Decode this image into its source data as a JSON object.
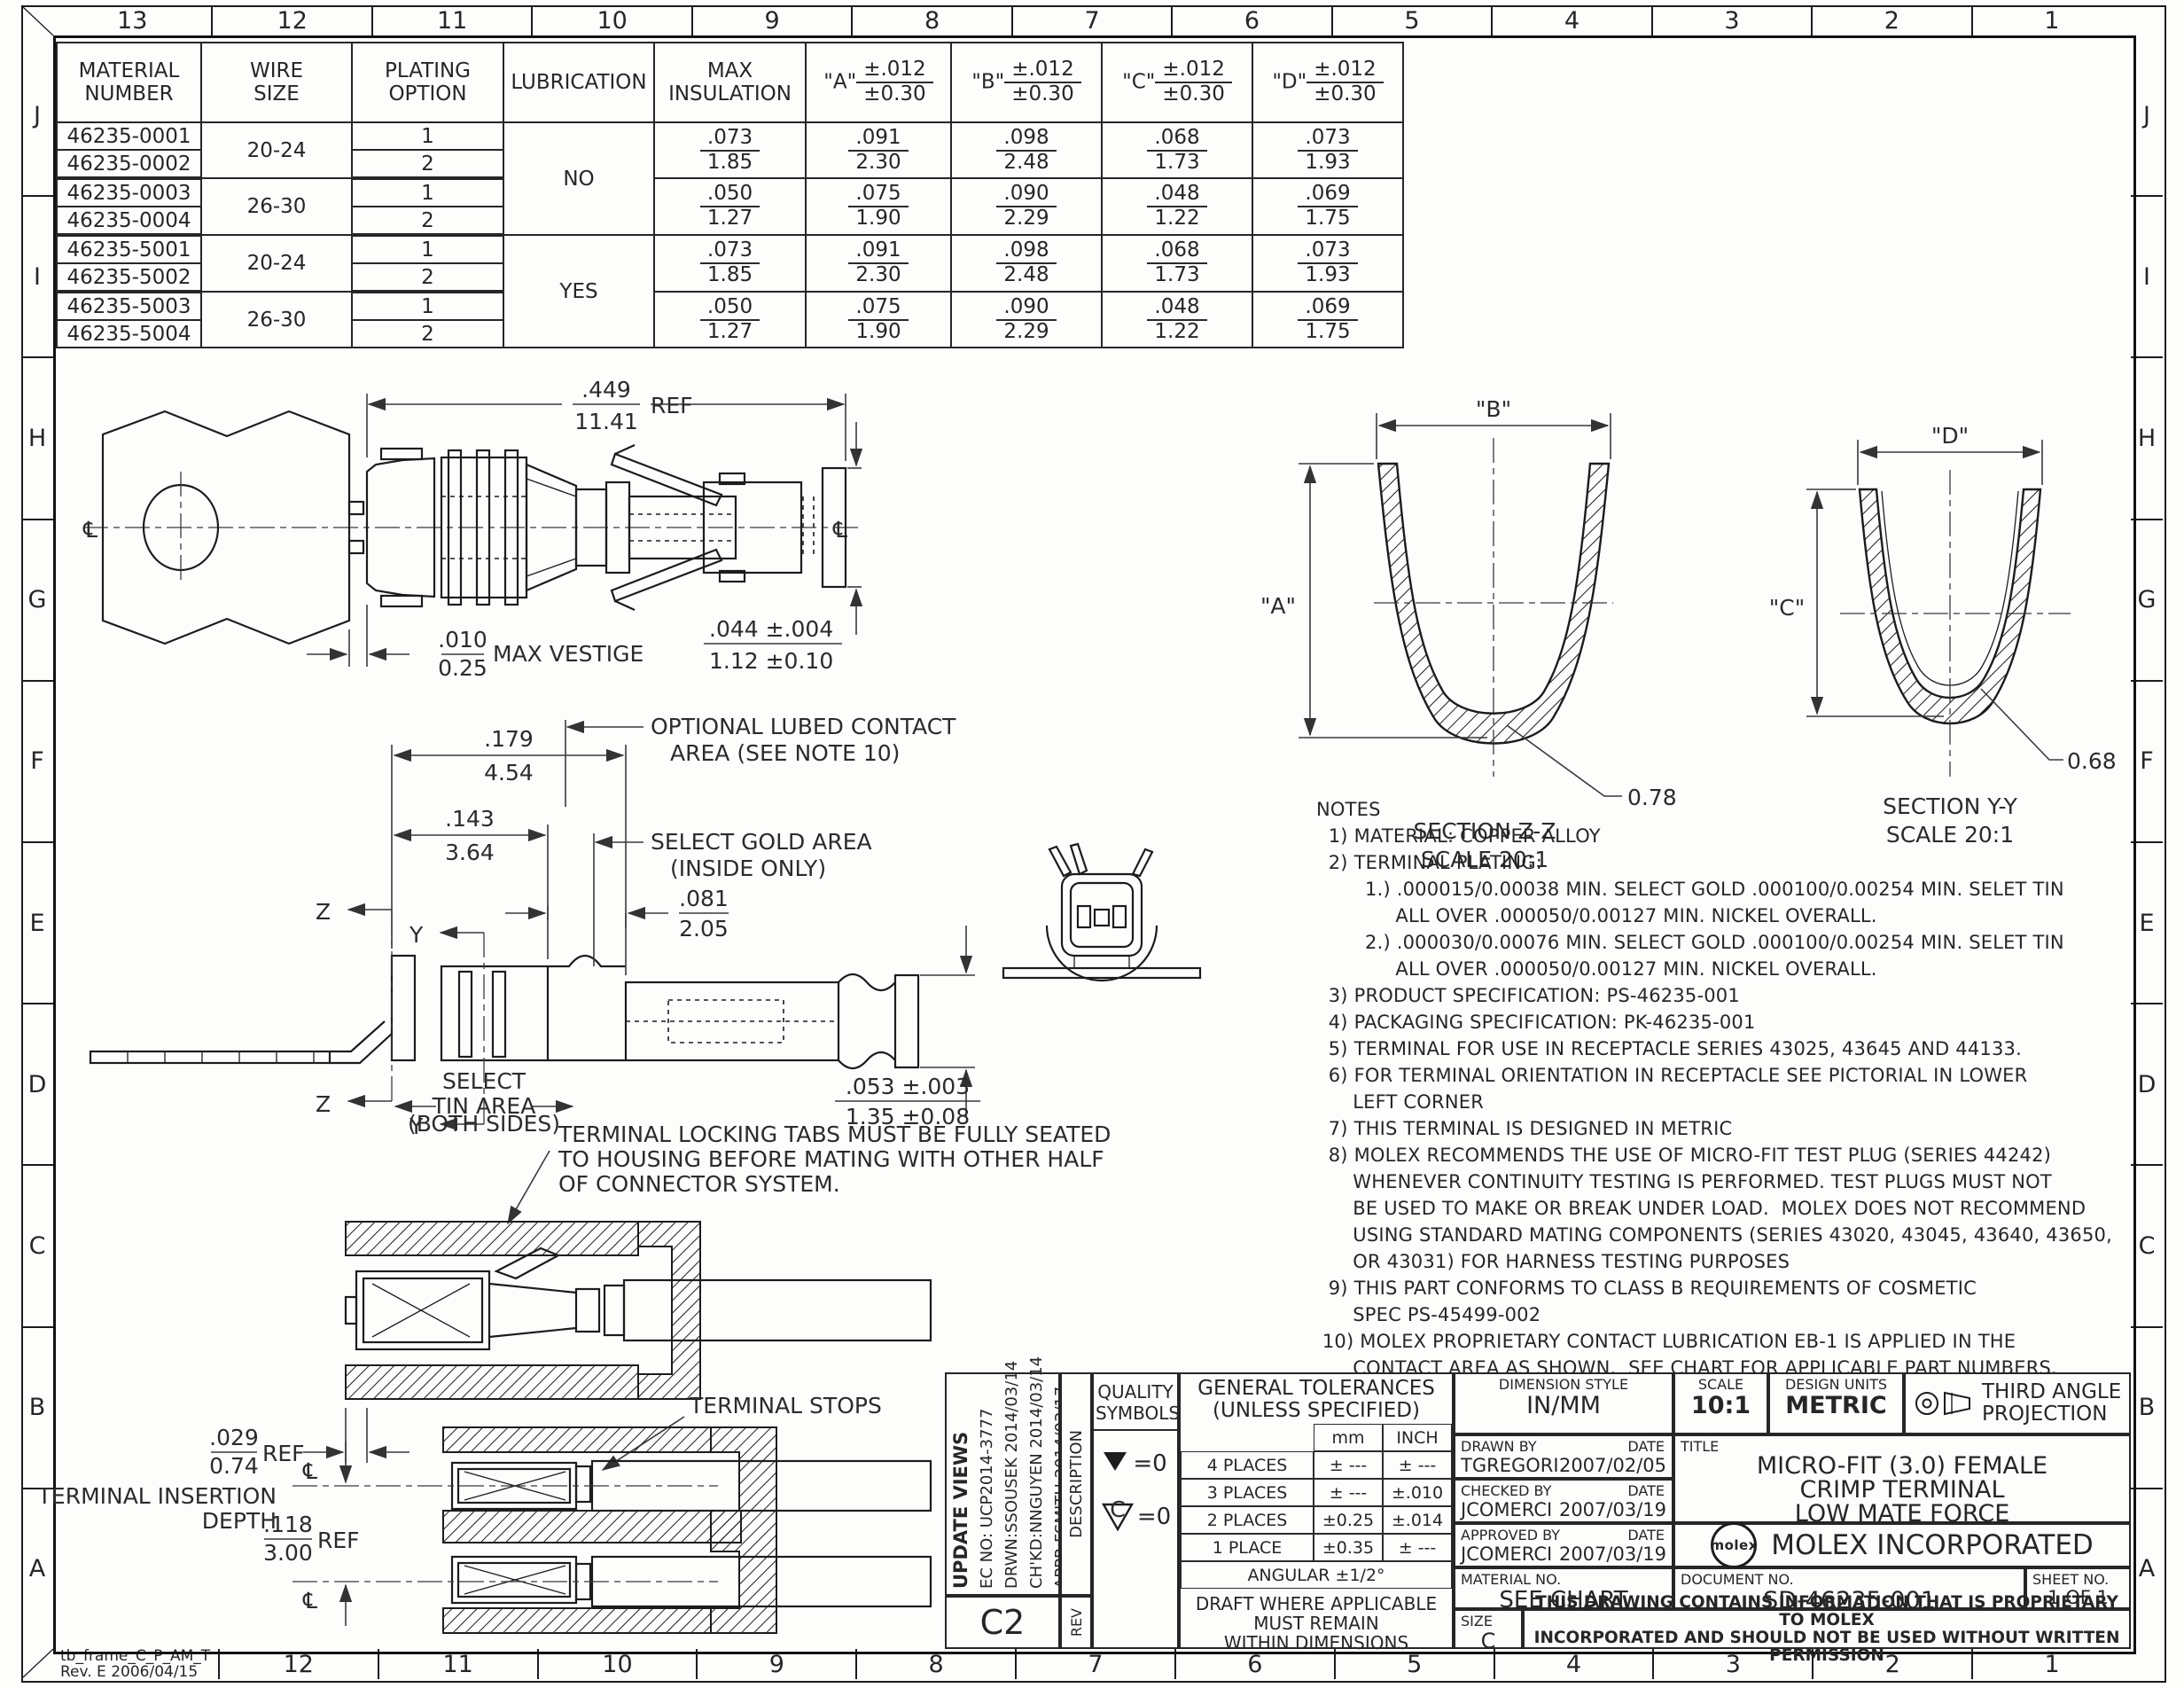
{
  "sheet": {
    "zones_top": [
      "13",
      "12",
      "11",
      "10",
      "9",
      "8",
      "7",
      "6",
      "5",
      "4",
      "3",
      "2",
      "1"
    ],
    "zones_bottom": [
      "12",
      "11",
      "10",
      "9",
      "8",
      "7",
      "6",
      "5",
      "4",
      "3",
      "2",
      "1"
    ],
    "zones_left": [
      "J",
      "I",
      "H",
      "G",
      "F",
      "E",
      "D",
      "C",
      "B",
      "A"
    ],
    "zones_right": [
      "J",
      "I",
      "H",
      "G",
      "F",
      "E",
      "D",
      "C",
      "B",
      "A"
    ],
    "frame_stamp": "tb_frame_C_P_AM_T\nRev. E 2006/04/15"
  },
  "parts_table": {
    "col_material": "MATERIAL\nNUMBER",
    "col_wire": "WIRE\nSIZE",
    "col_plating": "PLATING\nOPTION",
    "col_lube": "LUBRICATION",
    "col_ins": "MAX\nINSULATION",
    "dim_names": [
      "\"A\"",
      "\"B\"",
      "\"C\"",
      "\"D\""
    ],
    "tol_in": "±.012",
    "tol_mm": "±0.30",
    "lube_no": "NO",
    "lube_yes": "YES",
    "groups": [
      {
        "wire": "20-24",
        "rows": [
          [
            "46235-0001",
            "1"
          ],
          [
            "46235-0002",
            "2"
          ]
        ],
        "ins": [
          ".073",
          "1.85"
        ],
        "a": [
          ".091",
          "2.30"
        ],
        "b": [
          ".098",
          "2.48"
        ],
        "c": [
          ".068",
          "1.73"
        ],
        "d": [
          ".073",
          "1.93"
        ]
      },
      {
        "wire": "26-30",
        "rows": [
          [
            "46235-0003",
            "1"
          ],
          [
            "46235-0004",
            "2"
          ]
        ],
        "ins": [
          ".050",
          "1.27"
        ],
        "a": [
          ".075",
          "1.90"
        ],
        "b": [
          ".090",
          "2.29"
        ],
        "c": [
          ".048",
          "1.22"
        ],
        "d": [
          ".069",
          "1.75"
        ]
      },
      {
        "wire": "20-24",
        "rows": [
          [
            "46235-5001",
            "1"
          ],
          [
            "46235-5002",
            "2"
          ]
        ],
        "ins": [
          ".073",
          "1.85"
        ],
        "a": [
          ".091",
          "2.30"
        ],
        "b": [
          ".098",
          "2.48"
        ],
        "c": [
          ".068",
          "1.73"
        ],
        "d": [
          ".073",
          "1.93"
        ]
      },
      {
        "wire": "26-30",
        "rows": [
          [
            "46235-5003",
            "1"
          ],
          [
            "46235-5004",
            "2"
          ]
        ],
        "ins": [
          ".050",
          "1.27"
        ],
        "a": [
          ".075",
          "1.90"
        ],
        "b": [
          ".090",
          "2.29"
        ],
        "c": [
          ".048",
          "1.22"
        ],
        "d": [
          ".069",
          "1.75"
        ]
      }
    ]
  },
  "view_crimped": {
    "cl": "℄",
    "ref_in": ".449",
    "ref_mm": "11.41",
    "ref_label": "REF",
    "vest_in": ".010",
    "vest_mm": "0.25",
    "vest_label": "MAX VESTIGE",
    "tip_in": ".044 ±.004",
    "tip_mm": "1.12 ±0.10"
  },
  "section_zz": {
    "b": "\"B\"",
    "a": "\"A\"",
    "r": "0.78",
    "title": "SECTION Z-Z",
    "scale": "SCALE 20:1"
  },
  "section_yy": {
    "d": "\"D\"",
    "c": "\"C\"",
    "r": "0.68",
    "title": "SECTION Y-Y",
    "scale": "SCALE 20:1"
  },
  "view_side": {
    "z": "Z",
    "y": "Y",
    "d1_in": ".179",
    "d1_mm": "4.54",
    "d2_in": ".143",
    "d2_mm": "3.64",
    "d3_in": ".081",
    "d3_mm": "2.05",
    "d4_in": ".053 ±.003",
    "d4_mm": "1.35 ±0.08",
    "lube1": "OPTIONAL LUBED CONTACT",
    "lube2": "AREA (SEE NOTE 10)",
    "gold1": "SELECT GOLD AREA",
    "gold2": "(INSIDE ONLY)",
    "tin1": "SELECT",
    "tin2": "TIN AREA",
    "tin3": "(BOTH SIDES)"
  },
  "notes": {
    "text": "NOTES\n  1) MATERIAL: COPPER ALLOY\n  2) TERMINAL PLATING:\n        1.) .000015/0.00038 MIN. SELECT GOLD .000100/0.00254 MIN. SELET TIN\n             ALL OVER .000050/0.00127 MIN. NICKEL OVERALL.\n        2.) .000030/0.00076 MIN. SELECT GOLD .000100/0.00254 MIN. SELET TIN\n             ALL OVER .000050/0.00127 MIN. NICKEL OVERALL.\n  3) PRODUCT SPECIFICATION: PS-46235-001\n  4) PACKAGING SPECIFICATION: PK-46235-001\n  5) TERMINAL FOR USE IN RECEPTACLE SERIES 43025, 43645 AND 44133.\n  6) FOR TERMINAL ORIENTATION IN RECEPTACLE SEE PICTORIAL IN LOWER\n      LEFT CORNER\n  7) THIS TERMINAL IS DESIGNED IN METRIC\n  8) MOLEX RECOMMENDS THE USE OF MICRO-FIT TEST PLUG (SERIES 44242)\n      WHENEVER CONTINUITY TESTING IS PERFORMED. TEST PLUGS MUST NOT\n      BE USED TO MAKE OR BREAK UNDER LOAD.  MOLEX DOES NOT RECOMMEND\n      USING STANDARD MATING COMPONENTS (SERIES 43020, 43045, 43640, 43650,\n      OR 43031) FOR HARNESS TESTING PURPOSES\n  9) THIS PART CONFORMS TO CLASS B REQUIREMENTS OF COSMETIC\n      SPEC PS-45499-002\n 10) MOLEX PROPRIETARY CONTACT LUBRICATION EB-1 IS APPLIED IN THE\n      CONTACT AREA AS SHOWN.  SEE CHART FOR APPLICABLE PART NUMBERS."
  },
  "view_assembly": {
    "note1": "TERMINAL LOCKING TABS MUST BE FULLY SEATED",
    "note2": "TO HOUSING BEFORE MATING WITH OTHER HALF",
    "note3": "OF CONNECTOR SYSTEM.",
    "stops": "TERMINAL STOPS",
    "ins_in": ".029",
    "ins_mm": "0.74",
    "ref": "REF",
    "depth1": "TERMINAL INSERTION",
    "depth2": "DEPTH",
    "pitch_in": ".118",
    "pitch_mm": "3.00",
    "cl": "℄"
  },
  "title_block": {
    "rev_block": {
      "change": "UPDATE VIEWS",
      "ec_no": "EC NO: UCP2014-3777",
      "drwn": "DRWN:SSOUSEK  2014/03/14",
      "chkd": "CH'KD:NNGUYEN  2014/03/14",
      "appr": "APPR:FSMITH  2014/03/17",
      "rev": "C2",
      "description_label": "DESCRIPTION",
      "rev_label": "REV"
    },
    "quality": {
      "title": "QUALITY\nSYMBOLS",
      "sym1_val": "=0",
      "sym2_letter": "C",
      "sym2_val": "=0"
    },
    "tolerances": {
      "title": "GENERAL TOLERANCES",
      "subtitle": "(UNLESS SPECIFIED)",
      "col_mm": "mm",
      "col_inch": "INCH",
      "r1_label": "4 PLACES",
      "r1_mm": "± ---",
      "r1_in": "± ---",
      "r2_label": "3 PLACES",
      "r2_mm": "± ---",
      "r2_in": "±.010",
      "r3_label": "2 PLACES",
      "r3_mm": "±0.25",
      "r3_in": "±.014",
      "r4_label": "1 PLACE",
      "r4_mm": "±0.35",
      "r4_in": "± ---",
      "angular": "ANGULAR ±1/2°",
      "draft": "DRAFT WHERE APPLICABLE\nMUST REMAIN\nWITHIN DIMENSIONS"
    },
    "info": {
      "dim_style_label": "DIMENSION STYLE",
      "dim_style": "IN/MM",
      "scale_label": "SCALE",
      "scale": "10:1",
      "units_label": "DESIGN UNITS",
      "units": "METRIC",
      "projection": "THIRD ANGLE\nPROJECTION",
      "drawn_label": "DRAWN BY",
      "date_label": "DATE",
      "drawn_by": "TGREGORI",
      "drawn_date": "2007/02/05",
      "checked_label": "CHECKED BY",
      "checked_by": "JCOMERCI",
      "checked_date": "2007/03/19",
      "approved_label": "APPROVED BY",
      "approved_by": "JCOMERCI",
      "approved_date": "2007/03/19",
      "title_label": "TITLE",
      "title": "MICRO-FIT (3.0) FEMALE\nCRIMP TERMINAL\nLOW MATE FORCE",
      "logo": "molex",
      "company": "MOLEX INCORPORATED",
      "material_label": "MATERIAL NO.",
      "material": "SEE CHART",
      "doc_label": "DOCUMENT NO.",
      "doc_no": "SD-46235-001",
      "sheet_label": "SHEET NO.",
      "sheet": "1 OF 1",
      "size_label": "SIZE",
      "size": "C",
      "proprietary": "THIS DRAWING CONTAINS INFORMATION THAT IS PROPRIETARY TO MOLEX\nINCORPORATED AND SHOULD NOT BE USED WITHOUT WRITTEN PERMISSION"
    }
  }
}
